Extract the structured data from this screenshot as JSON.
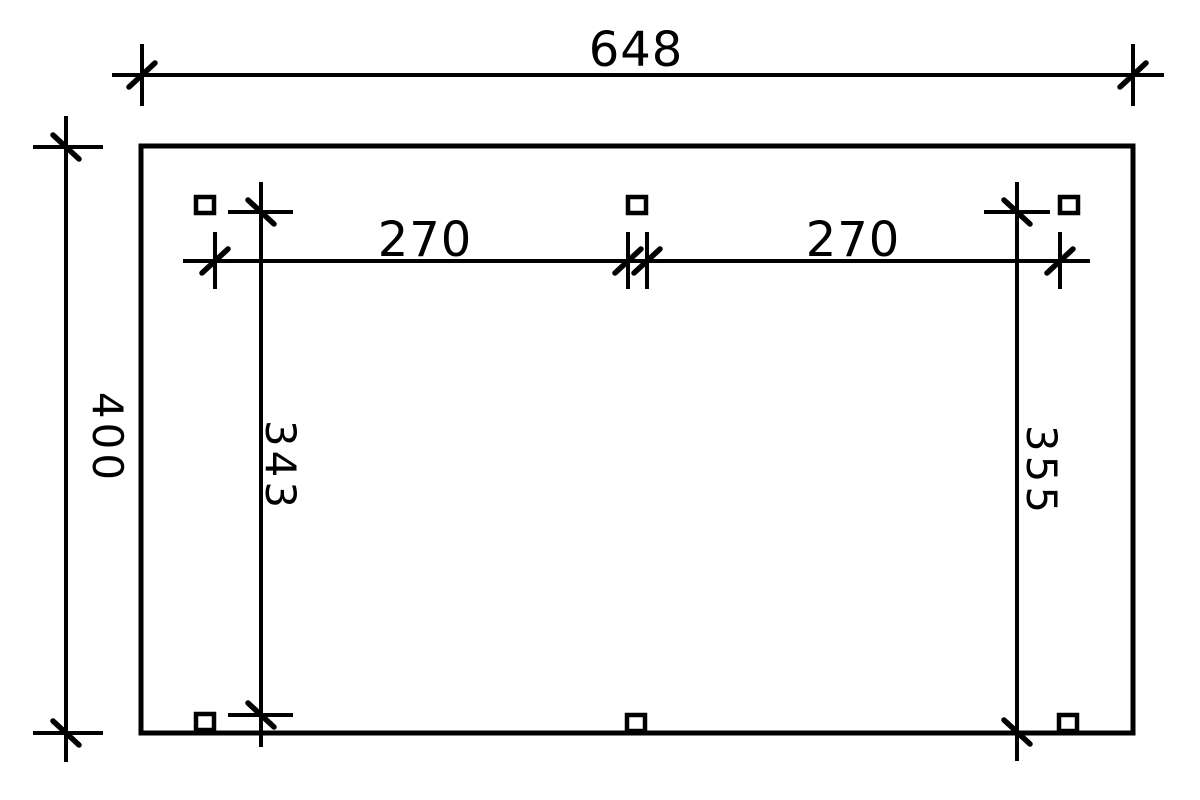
{
  "drawing": {
    "background_color": "#ffffff",
    "line_color": "#000000",
    "labels": {
      "total_width": "648",
      "total_height": "400",
      "left_bay_width": "270",
      "right_bay_width": "270",
      "left_post_distance": "343",
      "right_post_distance": "355"
    }
  }
}
